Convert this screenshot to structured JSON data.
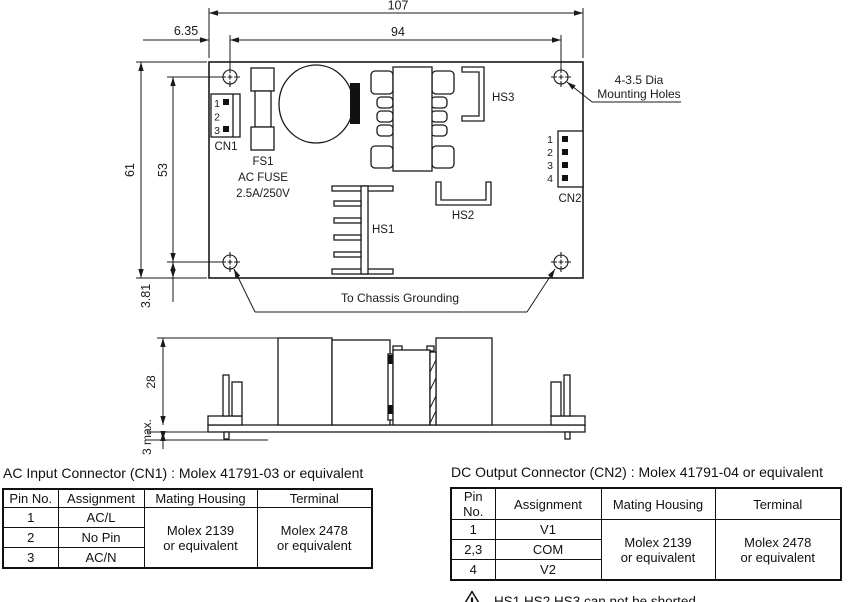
{
  "top_view": {
    "dim_total_width": "107",
    "dim_inner_width": "94",
    "dim_edge_offset": "6.35",
    "dim_total_height": "61",
    "dim_inner_height": "53",
    "dim_bottom_offset": "3.81",
    "cn1_label": "CN1",
    "cn1_pins": [
      "1",
      "2",
      "3"
    ],
    "fuse_ref": "FS1",
    "fuse_line1": "AC FUSE",
    "fuse_line2": "2.5A/250V",
    "hs1_label": "HS1",
    "hs2_label": "HS2",
    "hs3_label": "HS3",
    "cn2_label": "CN2",
    "cn2_pins": [
      "1",
      "2",
      "3",
      "4"
    ],
    "mounting_note_line1": "4-3.5 Dia",
    "mounting_note_line2": "Mounting Holes",
    "grounding_note": "To Chassis Grounding"
  },
  "side_view": {
    "dim_height": "28",
    "dim_pin": "3 max."
  },
  "ac_table": {
    "title": "AC Input Connector (CN1) : Molex 41791-03 or equivalent",
    "headers": [
      "Pin No.",
      "Assignment",
      "Mating Housing",
      "Terminal"
    ],
    "rows": [
      [
        "1",
        "AC/L"
      ],
      [
        "2",
        "No Pin"
      ],
      [
        "3",
        "AC/N"
      ]
    ],
    "mating_housing": "Molex 2139\nor equivalent",
    "terminal": "Molex 2478\nor equivalent"
  },
  "dc_table": {
    "title": "DC Output Connector (CN2) : Molex 41791-04 or equivalent",
    "headers": [
      "Pin No.",
      "Assignment",
      "Mating Housing",
      "Terminal"
    ],
    "rows": [
      [
        "1",
        "V1"
      ],
      [
        "2,3",
        "COM"
      ],
      [
        "4",
        "V2"
      ]
    ],
    "mating_housing": "Molex 2139\nor equivalent",
    "terminal": "Molex 2478\nor equivalent"
  },
  "warning": "HS1,HS2,HS3 can not be shorted"
}
